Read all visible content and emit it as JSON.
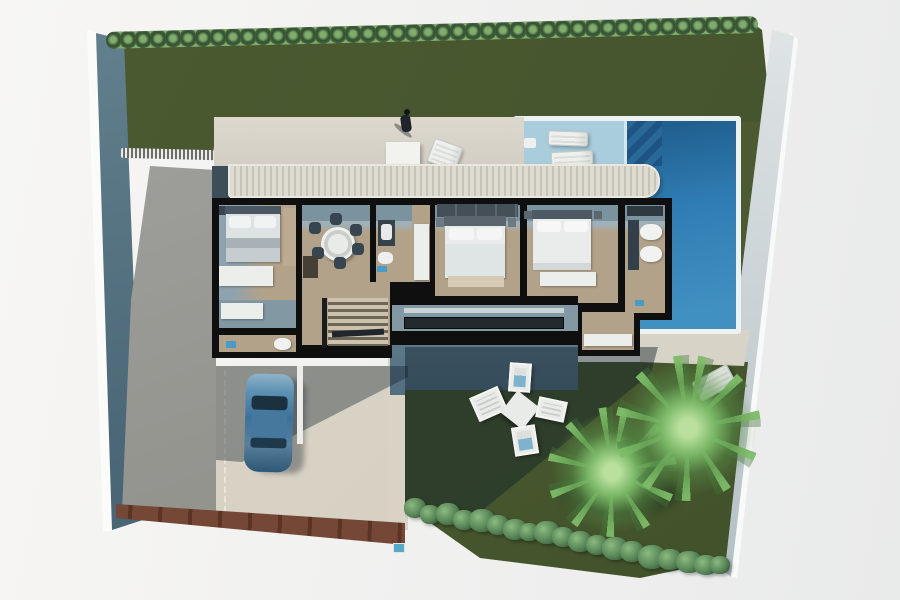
{
  "scene": {
    "title": "Top-view 3D rendering of a modern villa plot with pool, garden and driveway",
    "style": "architectural-render",
    "view": "top-down floor plan"
  },
  "colors": {
    "lawn_top": "#4c5a31",
    "lawn_bottom": "#47572e",
    "pool_shelf": "#a9cddd",
    "pool_deep": "#2f7cb2",
    "house_wall": "#0f0f0f",
    "floor_wood": "#b3a28a",
    "floor_gray": "#8299a4",
    "mat_blue": "#4a9cc8",
    "terrace_concrete": "#d6d2c8",
    "driveway_gray": "#9a9a96",
    "fence_brown": "#744736",
    "car_blue": "#4f86ac",
    "wall_left_blue": "#5b7a8c",
    "wall_right_gray": "#cfd6d9"
  },
  "site": {
    "areas": [
      "top lawn with hedge",
      "swimming pool with tanning shelf and corner steps",
      "north terrace with pergola",
      "villa floor plan",
      "driveway ramp",
      "carport apron with parked car",
      "south garden lawn",
      "perimeter walls"
    ],
    "plants": {
      "palm_trees": 2,
      "hedge_rows": 2,
      "garden_bushes": 19
    },
    "rooms": [
      {
        "name": "bedroom-1",
        "furniture": [
          "double bed",
          "dresser",
          "wardrobe"
        ]
      },
      {
        "name": "dining-room",
        "furniture": [
          "round table",
          "six chairs",
          "cabinet"
        ]
      },
      {
        "name": "bathroom-1",
        "furniture": [
          "vanity sink",
          "toilet",
          "open door"
        ]
      },
      {
        "name": "master-bedroom",
        "furniture": [
          "wardrobe wall",
          "double bed",
          "foot bench"
        ]
      },
      {
        "name": "bedroom-2",
        "furniture": [
          "double bed",
          "bench"
        ]
      },
      {
        "name": "bathroom-2",
        "furniture": [
          "double vanity",
          "shower"
        ]
      },
      {
        "name": "hallway",
        "furniture": [
          "bench"
        ]
      },
      {
        "name": "laundry-wc",
        "furniture": [
          "toilet",
          "mat"
        ]
      },
      {
        "name": "staircase",
        "furniture": [
          "stairs",
          "handrail"
        ]
      },
      {
        "name": "corridor-gallery",
        "furniture": [
          "window band"
        ]
      },
      {
        "name": "south-balcony",
        "furniture": [
          "bench"
        ]
      }
    ],
    "exterior_items": [
      "two pool loungers",
      "terrace table",
      "terrace lounger",
      "standing person",
      "blue car",
      "four garden chairs",
      "square garden table",
      "gate strip",
      "brown timber edge"
    ]
  }
}
